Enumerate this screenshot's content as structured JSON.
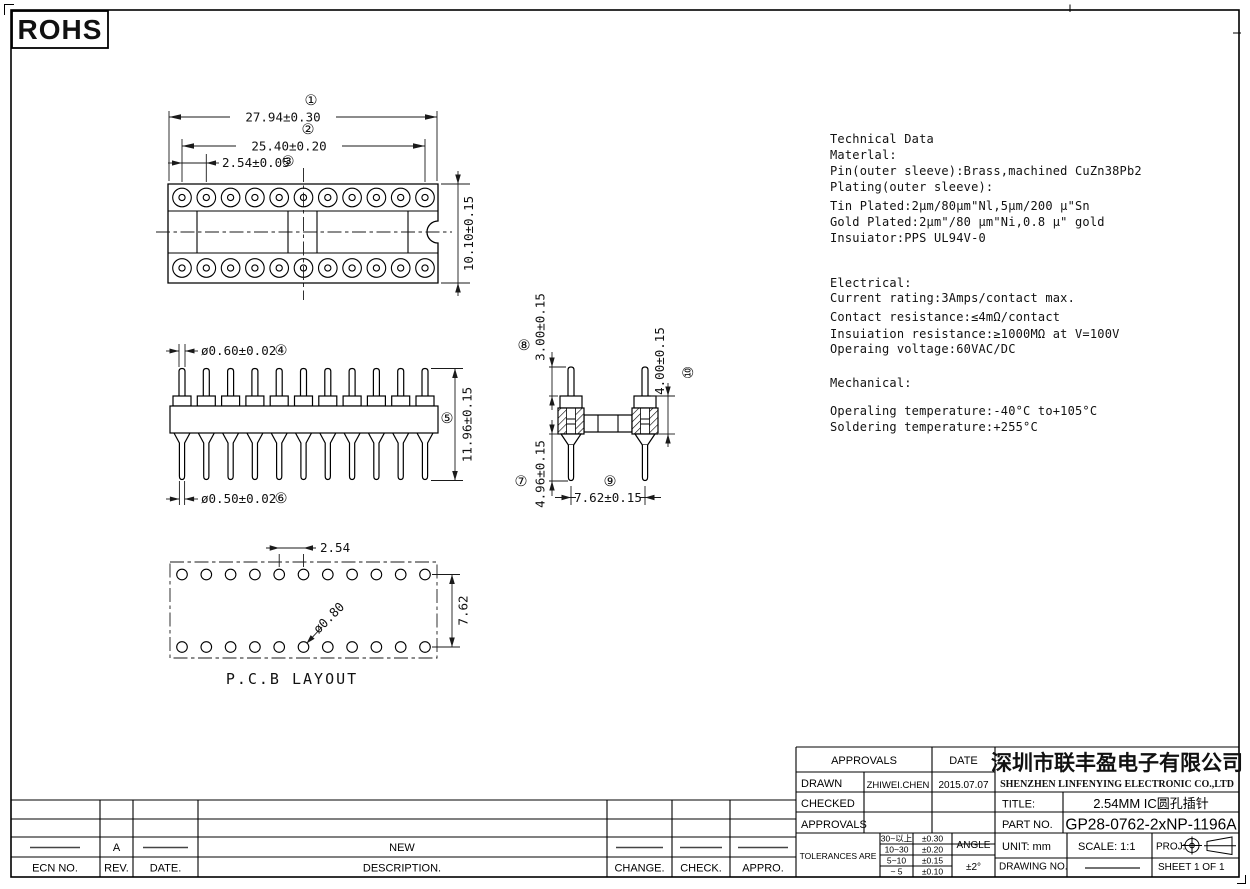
{
  "frame": {
    "rohs": "ROHS"
  },
  "tech": {
    "lines": [
      "Technical Data",
      "Materlal:",
      "Pin(outer sleeve):Brass,machined CuZn38Pb2",
      "Plating(outer sleeve):",
      "Tin Plated:2μm/80μm\"Nl,5μm/200 μ\"Sn",
      "Gold Plated:2μm\"/80 μm\"Ni,0.8 μ\" gold",
      "Insuiator:PPS UL94V-0",
      "Electrical:",
      "Current rating:3Amps/contact max.",
      "Contact resistance:≤4mΩ/contact",
      "Insuiation resistance:≥1000MΩ at V=100V",
      "Operaing voltage:60VAC/DC",
      "Mechanical:",
      "Operaling temperature:-40°C  to+105°C",
      "Soldering temperature:+255°C"
    ]
  },
  "dims": {
    "overall_width": "27.94±0.30",
    "pin_span": "25.40±0.20",
    "pitch": "2.54±0.05",
    "body_height": "10.10±0.15",
    "top_pin_dia": "ø0.60±0.02",
    "total_height": "11.96±0.15",
    "bottom_pin_dia": "ø0.50±0.02",
    "tail_length": "4.96±0.15",
    "top_pin_length": "3.00±0.15",
    "row_span": "7.62±0.15",
    "sleeve_height": "4.00±0.15",
    "pcb": {
      "pitch": "2.54",
      "hole": "ø0.80",
      "row_span": "7.62",
      "caption": "P.C.B LAYOUT"
    }
  },
  "balloons": {
    "b1": "①",
    "b2": "②",
    "b3": "③",
    "b4": "④",
    "b5": "⑤",
    "b6": "⑥",
    "b7": "⑦",
    "b8": "⑧",
    "b9": "⑨",
    "b10": "⑩"
  },
  "titleblock": {
    "approvals_header": "APPROVALS",
    "date_header": "DATE",
    "drawn_label": "DRAWN",
    "drawn_value": "ZHIWEI.CHEN",
    "drawn_date": "2015.07.07",
    "checked_label": "CHECKED",
    "approvals_label": "APPROVALS",
    "tolerances_label": "TOLERANCES ARE",
    "tol": [
      {
        "range": "30~以上",
        "value": "±0.30"
      },
      {
        "range": "10~30",
        "value": "±0.20"
      },
      {
        "range": "5~10",
        "value": "±0.15"
      },
      {
        "range": "~ 5",
        "value": "±0.10"
      }
    ],
    "angle_label": "ANGLE",
    "angle_value": "±2°",
    "company_cn": "深圳市联丰盈电子有限公司",
    "company_en": "SHENZHEN LINFENYING ELECTRONIC CO.,LTD",
    "title_label": "TITLE:",
    "title_value": "2.54MM IC圆孔插针",
    "part_label": "PART NO.",
    "part_value": "GP28-0762-2xNP-1196A",
    "unit_label": "UNIT:  mm",
    "scale_label": "SCALE:  1:1",
    "proj_label": "PROJ:",
    "drawing_label": "DRAWING NO.",
    "sheet_label": "SHEET  1 OF 1"
  },
  "revision": {
    "ecn_label": "ECN NO.",
    "rev_label": "REV.",
    "date_label": "DATE.",
    "desc_label": "DESCRIPTION.",
    "change_label": "CHANGE.",
    "check_label": "CHECK.",
    "appro_label": "APPRO.",
    "row_rev": "A",
    "row_desc": "NEW"
  }
}
